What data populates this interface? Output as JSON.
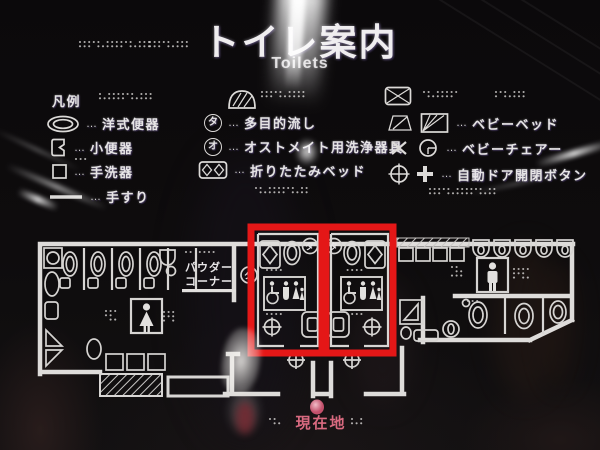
{
  "title": {
    "ja": "トイレ案内",
    "en": "Toilets"
  },
  "legend": {
    "heading": "凡例",
    "separator": "…",
    "columns": [
      {
        "items": [
          {
            "icon": "western-toilet-icon",
            "label": "洋式便器"
          },
          {
            "icon": "urinal-icon",
            "label": "小便器"
          },
          {
            "icon": "hand-washer-icon",
            "label": "手洗器"
          },
          {
            "icon": "handrail-icon",
            "label": "手すり"
          }
        ]
      },
      {
        "items": [
          {
            "icon": "circled-ta-icon",
            "symbol": "タ",
            "label": "多目的流し"
          },
          {
            "icon": "circled-o-icon",
            "symbol": "オ",
            "label": "オストメイト用洗浄器具"
          },
          {
            "icon": "folding-bed-icon",
            "label": "折りたたみベッド"
          }
        ]
      },
      {
        "items": [
          {
            "icon": "baby-bed-icon",
            "label": "ベビーベッド"
          },
          {
            "icon": "baby-chair-icon",
            "label": "ベビーチェアー"
          },
          {
            "icon": "door-button-icon",
            "label": "自動ドア開閉ボタン"
          }
        ]
      }
    ]
  },
  "map": {
    "powder_line1": "パウダー",
    "powder_line2": "コーナー",
    "current_location": "現在地",
    "room_symbol": "タ"
  },
  "colors": {
    "highlight_red": "#e41717",
    "location_pink": "#d96a80",
    "line_white": "#d8d6d4",
    "background": "#0d0b0c"
  }
}
